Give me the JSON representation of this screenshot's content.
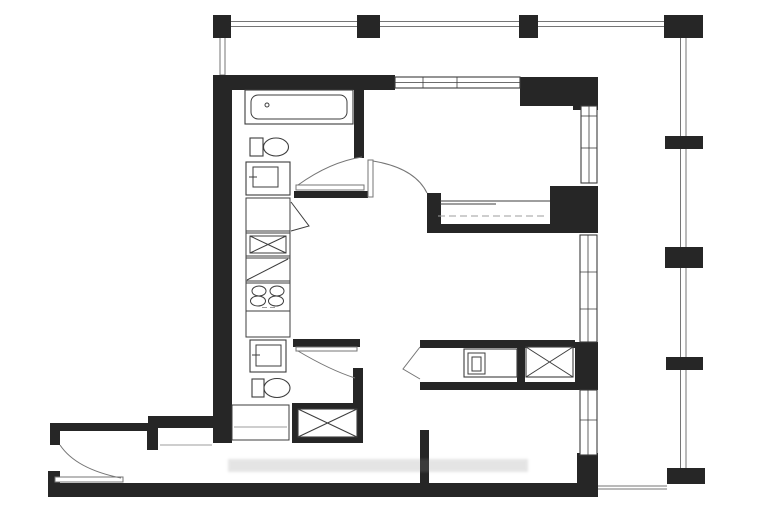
{
  "colors": {
    "paper": "#ffffff",
    "wall": "#262626",
    "line": "#3d3d3d",
    "thin": "#757575",
    "light": "#9d9d9d",
    "watermark": "#8a8a8a"
  },
  "plan": {
    "type": "floor-plan",
    "visible_text": "",
    "fixtures": [
      "bathtub",
      "toilet",
      "sink-vanity",
      "pantry-x-box",
      "diagonal-counter-cell",
      "cooktop-4-burner",
      "second-toilet",
      "second-sink-vanity",
      "closet-shelf",
      "storage-x-box",
      "washer",
      "laundry-x-box",
      "sliding-door-closet",
      "hinged-doors",
      "entry-door",
      "balcony-columns",
      "balcony-railing",
      "windows"
    ]
  }
}
